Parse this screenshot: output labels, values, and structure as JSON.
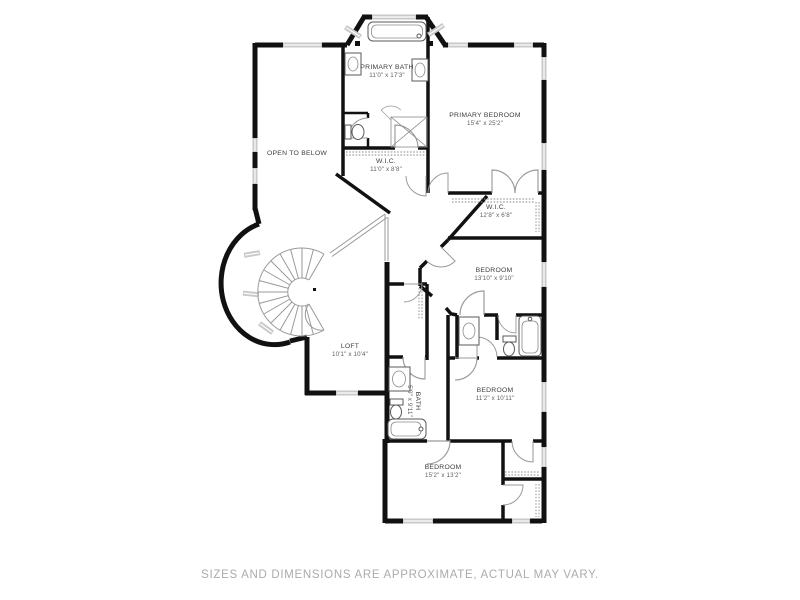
{
  "meta": {
    "disclaimer": "SIZES AND DIMENSIONS ARE APPROXIMATE, ACTUAL MAY VARY."
  },
  "colors": {
    "background": "#ffffff",
    "wall": "#111111",
    "window": "#c9c9c9",
    "door_arc": "#9a9a9a",
    "room_label": "#3d3d3d",
    "room_dims": "#5f5f5f",
    "disclaimer_text": "#ababab"
  },
  "rooms": [
    {
      "key": "primary-bath",
      "name": "PRIMARY BATH",
      "dims": "11'0\" x 17'3\""
    },
    {
      "key": "primary-bedroom",
      "name": "PRIMARY BEDROOM",
      "dims": "15'4\" x 25'2\""
    },
    {
      "key": "open-to-below",
      "name": "OPEN TO BELOW",
      "dims": ""
    },
    {
      "key": "wic-primary",
      "name": "W.I.C.",
      "dims": "11'0\" x 8'8\""
    },
    {
      "key": "wic-secondary",
      "name": "W.I.C.",
      "dims": "12'8\" x 6'8\""
    },
    {
      "key": "bedroom-2",
      "name": "BEDROOM",
      "dims": "13'10\" x 9'10\""
    },
    {
      "key": "loft",
      "name": "LOFT",
      "dims": "10'1\" x 10'4\""
    },
    {
      "key": "hall-bath",
      "name": "BATH",
      "dims": "5'0\" x 9'11\""
    },
    {
      "key": "bedroom-3",
      "name": "BEDROOM",
      "dims": "11'2\" x 10'11\""
    },
    {
      "key": "bedroom-4",
      "name": "BEDROOM",
      "dims": "15'2\" x 13'2\""
    }
  ]
}
